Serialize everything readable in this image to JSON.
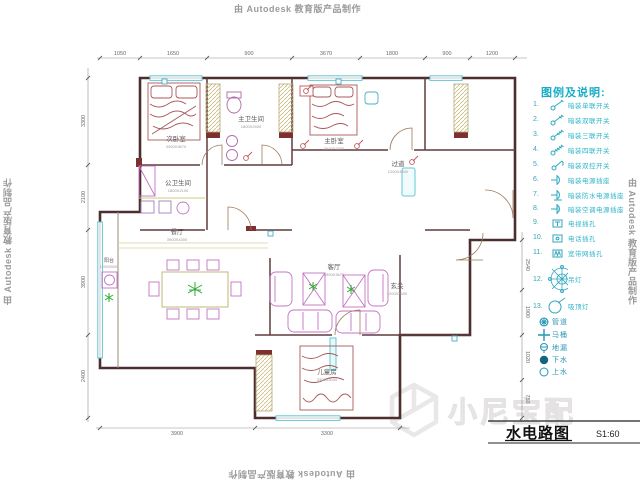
{
  "watermarks": {
    "autodesk": "由 Autodesk 教育版产品制作",
    "brand": "小尼宝配"
  },
  "title_block": {
    "title": "水电路图",
    "scale": "S1:60"
  },
  "legend": {
    "title": "图例及说明:",
    "items": [
      {
        "num": "1.",
        "icon": "single-gang-switch-icon",
        "label": "暗装单联开关"
      },
      {
        "num": "2.",
        "icon": "double-gang-switch-icon",
        "label": "暗装双联开关"
      },
      {
        "num": "3.",
        "icon": "triple-gang-switch-icon",
        "label": "暗装三联开关"
      },
      {
        "num": "4.",
        "icon": "quad-gang-switch-icon",
        "label": "暗装四联开关"
      },
      {
        "num": "5.",
        "icon": "two-way-switch-icon",
        "label": "暗装双控开关"
      },
      {
        "num": "6.",
        "icon": "power-socket-icon",
        "label": "暗装电源插座"
      },
      {
        "num": "7.",
        "icon": "waterproof-socket-icon",
        "label": "暗装防水电源插座"
      },
      {
        "num": "8.",
        "icon": "ac-socket-icon",
        "label": "暗装空调电源插座"
      },
      {
        "num": "9.",
        "icon": "tv-outlet-icon",
        "label": "电视插孔"
      },
      {
        "num": "10.",
        "icon": "phone-outlet-icon",
        "label": "电话插孔"
      },
      {
        "num": "11.",
        "icon": "network-outlet-icon",
        "label": "宽带网插孔"
      },
      {
        "num": "12.",
        "icon": "chandelier-icon",
        "label": "吊灯"
      },
      {
        "num": "13.",
        "icon": "ceiling-lamp-icon",
        "label": "吸顶灯"
      }
    ],
    "pipe_items": [
      {
        "icon": "pipe-icon",
        "label": "管道"
      },
      {
        "icon": "toilet-icon",
        "label": "马桶"
      },
      {
        "icon": "floor-drain-icon",
        "label": "地漏"
      },
      {
        "icon": "waste-water-icon",
        "label": "下水"
      },
      {
        "icon": "supply-water-icon",
        "label": "上水"
      }
    ]
  },
  "rooms": [
    {
      "name": "次卧室",
      "dims": "3300X3670"
    },
    {
      "name": "主卫生间",
      "dims": "1800X2400"
    },
    {
      "name": "主卧室",
      "dims": "3670X3300"
    },
    {
      "name": "过道",
      "dims": "1200X4800"
    },
    {
      "name": "公卫生间",
      "dims": "1800X2100"
    },
    {
      "name": "餐厅",
      "dims": "3900X4300"
    },
    {
      "name": "客厅",
      "dims": "3900X3670"
    },
    {
      "name": "玄关",
      "dims": "1200X2400"
    },
    {
      "name": "儿童房",
      "dims": "3300X3000"
    },
    {
      "name": "阳台",
      "dims": "1200X5000"
    }
  ],
  "dimensions": {
    "top": [
      "1050",
      "1650",
      "900",
      "3670",
      "1800",
      "900",
      "1200"
    ],
    "left": [
      "3300",
      "2100",
      "3900",
      "2400"
    ],
    "right": [
      "2540",
      "1900",
      "1020",
      "750"
    ],
    "bottom": [
      "3900",
      "3300"
    ]
  }
}
